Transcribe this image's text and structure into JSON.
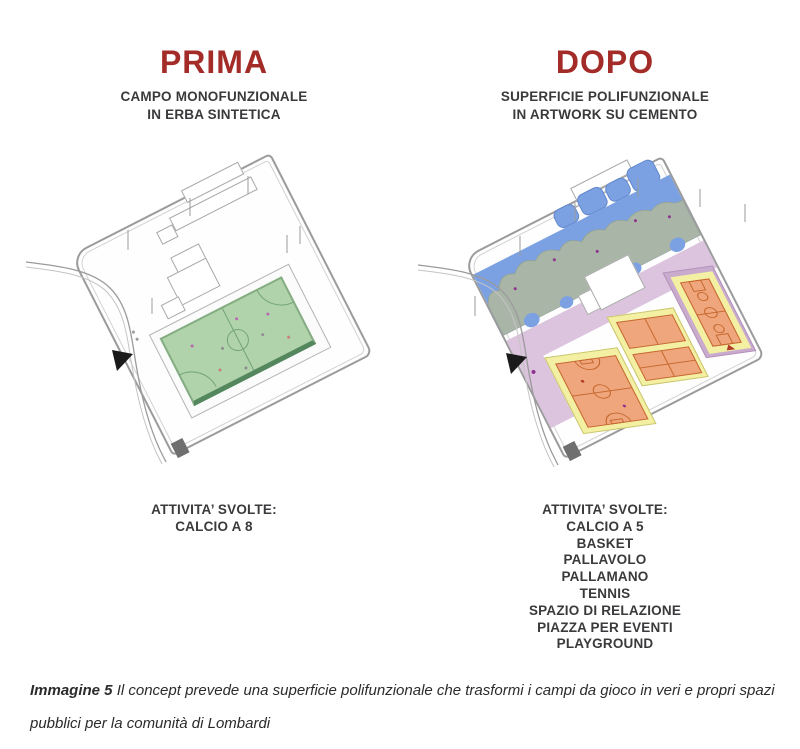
{
  "panels": {
    "before": {
      "title": "PRIMA",
      "subtitle": [
        "CAMPO MONOFUNZIONALE",
        "IN ERBA SINTETICA"
      ],
      "activities_header": "ATTIVITA’ SVOLTE:",
      "activities": [
        "CALCIO A 8"
      ]
    },
    "after": {
      "title": "DOPO",
      "subtitle": [
        "SUPERFICIE POLIFUNZIONALE",
        "IN ARTWORK SU CEMENTO"
      ],
      "activities_header": "ATTIVITA’ SVOLTE:",
      "activities": [
        "CALCIO A 5",
        "BASKET",
        "PALLAVOLO",
        "PALLAMANO",
        "TENNIS",
        "SPAZIO DI RELAZIONE",
        "PIAZZA PER EVENTI",
        "PLAYGROUND"
      ]
    }
  },
  "caption": {
    "label": "Immagine 5",
    "text": " Il concept prevede una superficie polifunzionale che trasformi i campi da gioco in veri e propri spazi pubblici per la comunità di Lombardi"
  },
  "colors": {
    "title_red": "#a32c28",
    "text_dark": "#3a3a3c",
    "field_green": "#b0d3ab",
    "field_line_green": "#74a377",
    "field_edge_green": "#55875f",
    "playground_blue": "#7ba1e3",
    "playground_gray": "#a9b5a7",
    "walkway_pink": "#dcc3de",
    "court_frame_purple": "#c9abce",
    "court_yellow": "#f3f0a3",
    "court_orange": "#f0a67c",
    "court_line_orange": "#c4682f",
    "site_outline_gray": "#9b9b9b"
  }
}
